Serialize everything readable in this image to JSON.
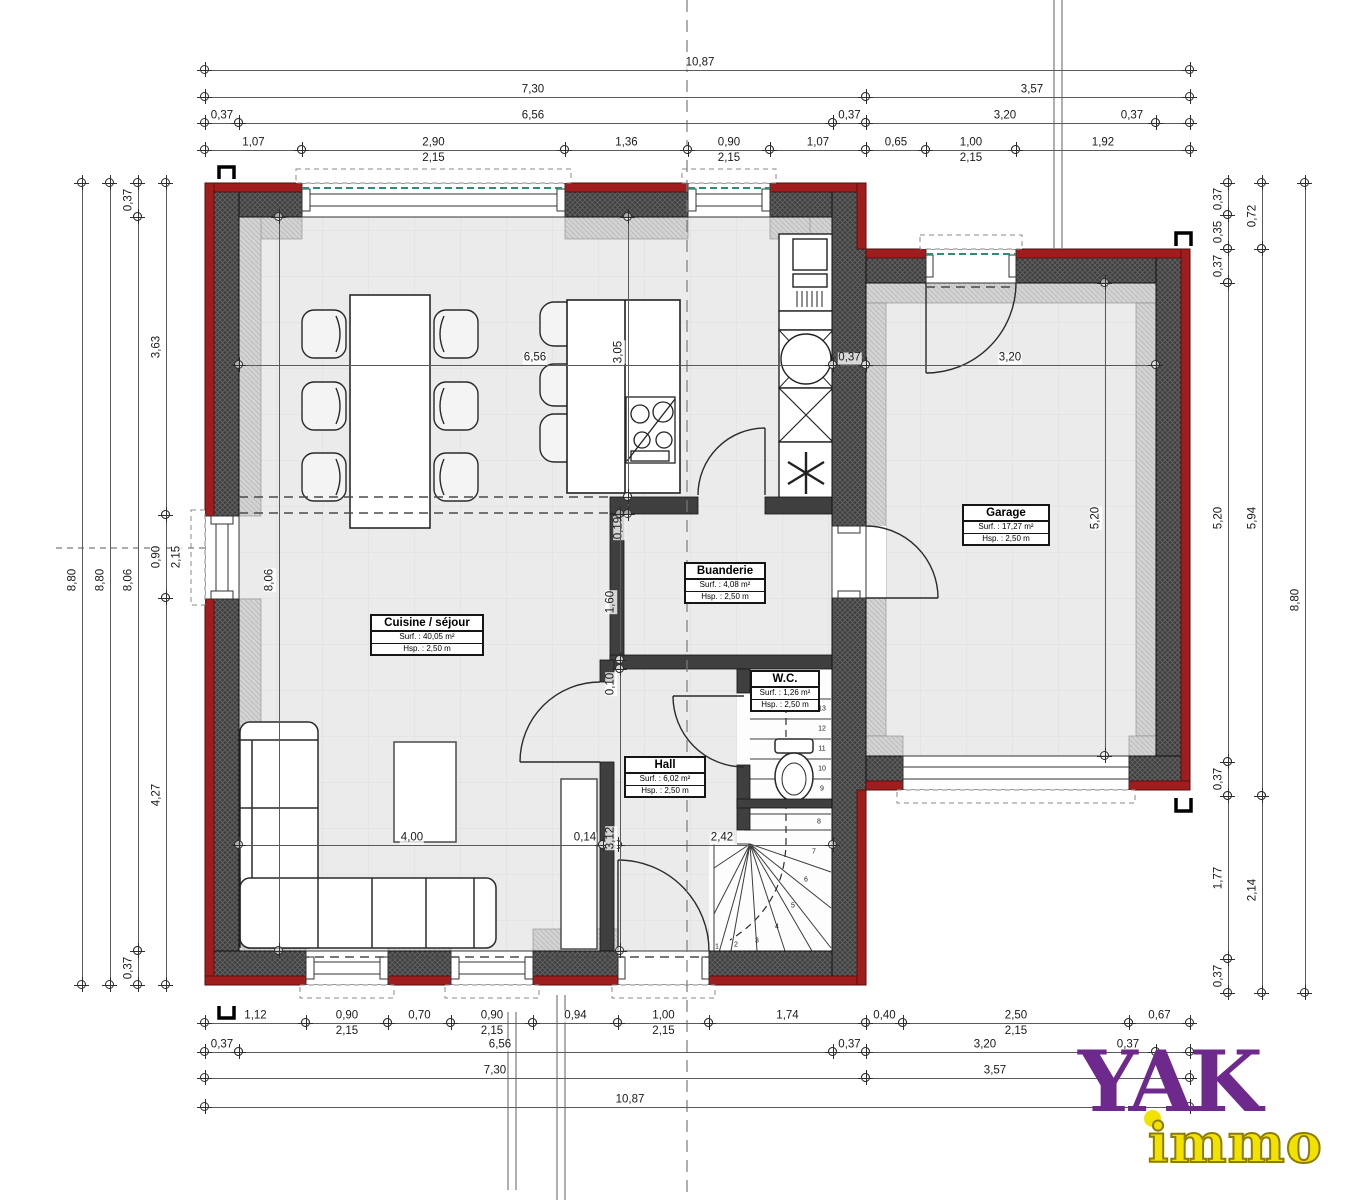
{
  "logo": {
    "brand": "YAK",
    "sub": "immo"
  },
  "colors": {
    "wall_red": "#a01d1d",
    "wall_dark": "#3f3f3f",
    "floor": "#ebebeb",
    "dim_line": "#5a5a5a",
    "brand_purple": "#6d2a8c",
    "brand_yellow": "#f2e200"
  },
  "rooms": [
    {
      "name": "Cuisine / séjour",
      "surface": "Surf. : 40,05 m²",
      "height": "Hsp. : 2,50 m",
      "x": 370,
      "y": 614,
      "w": 114
    },
    {
      "name": "Garage",
      "surface": "Surf. : 17,27 m²",
      "height": "Hsp. : 2,50 m",
      "x": 962,
      "y": 504,
      "w": 88
    },
    {
      "name": "Buanderie",
      "surface": "Surf. : 4,08 m²",
      "height": "Hsp. : 2,50 m",
      "x": 684,
      "y": 562,
      "w": 82
    },
    {
      "name": "W.C.",
      "surface": "Surf. : 1,26 m²",
      "height": "Hsp. : 2,50 m",
      "x": 750,
      "y": 670,
      "w": 70
    },
    {
      "name": "Hall",
      "surface": "Surf. : 6,02 m²",
      "height": "Hsp. : 2,50 m",
      "x": 624,
      "y": 756,
      "w": 82
    }
  ],
  "dims_h": [
    {
      "y": 70,
      "x1": 205,
      "x2": 1190,
      "t": "10,87",
      "lx": 700
    },
    {
      "y": 97,
      "x1": 205,
      "x2": 866,
      "t": "7,30",
      "lx": 533
    },
    {
      "y": 97,
      "x1": 866,
      "x2": 1190,
      "t": "3,57",
      "lx": 1032
    },
    {
      "y": 123,
      "x1": 205,
      "x2": 239,
      "t": "0,37"
    },
    {
      "y": 123,
      "x1": 239,
      "x2": 833,
      "t": "6,56",
      "lx": 533
    },
    {
      "y": 123,
      "x1": 833,
      "x2": 866,
      "t": "0,37"
    },
    {
      "y": 123,
      "x1": 866,
      "x2": 1156,
      "t": "3,20",
      "lx": 1005
    },
    {
      "y": 123,
      "x1": 1156,
      "x2": 1190,
      "t": "0,37",
      "lx": 1132
    },
    {
      "y": 150,
      "x1": 205,
      "x2": 302,
      "t": "1,07"
    },
    {
      "y": 150,
      "x1": 302,
      "x2": 565,
      "t": "2,90",
      "t2": "2,15"
    },
    {
      "y": 150,
      "x1": 565,
      "x2": 688,
      "t": "1,36"
    },
    {
      "y": 150,
      "x1": 688,
      "x2": 770,
      "t": "0,90",
      "t2": "2,15"
    },
    {
      "y": 150,
      "x1": 770,
      "x2": 866,
      "t": "1,07"
    },
    {
      "y": 150,
      "x1": 866,
      "x2": 926,
      "t": "0,65"
    },
    {
      "y": 150,
      "x1": 926,
      "x2": 1016,
      "t": "1,00",
      "t2": "2,15"
    },
    {
      "y": 150,
      "x1": 1016,
      "x2": 1190,
      "t": "1,92"
    },
    {
      "y": 365,
      "x1": 239,
      "x2": 833,
      "t": "6,56",
      "lx": 535
    },
    {
      "y": 365,
      "x1": 833,
      "x2": 866,
      "t": "0,37"
    },
    {
      "y": 365,
      "x1": 866,
      "x2": 1156,
      "t": "3,20",
      "lx": 1010
    },
    {
      "y": 845,
      "x1": 239,
      "x2": 603,
      "t": "4,00",
      "lx": 412
    },
    {
      "y": 845,
      "x1": 603,
      "x2": 618,
      "t": "0,14",
      "lx": 585
    },
    {
      "y": 845,
      "x1": 618,
      "x2": 833,
      "t": "2,42",
      "lx": 722
    },
    {
      "y": 1023,
      "x1": 205,
      "x2": 306,
      "t": "1,12"
    },
    {
      "y": 1023,
      "x1": 306,
      "x2": 388,
      "t": "0,90",
      "t2": "2,15"
    },
    {
      "y": 1023,
      "x1": 388,
      "x2": 451,
      "t": "0,70"
    },
    {
      "y": 1023,
      "x1": 451,
      "x2": 533,
      "t": "0,90",
      "t2": "2,15"
    },
    {
      "y": 1023,
      "x1": 533,
      "x2": 618,
      "t": "0,94"
    },
    {
      "y": 1023,
      "x1": 618,
      "x2": 709,
      "t": "1,00",
      "t2": "2,15"
    },
    {
      "y": 1023,
      "x1": 709,
      "x2": 866,
      "t": "1,74"
    },
    {
      "y": 1023,
      "x1": 866,
      "x2": 903,
      "t": "0,40"
    },
    {
      "y": 1023,
      "x1": 903,
      "x2": 1129,
      "t": "2,50",
      "t2": "2,15"
    },
    {
      "y": 1023,
      "x1": 1129,
      "x2": 1190,
      "t": "0,67"
    },
    {
      "y": 1052,
      "x1": 205,
      "x2": 239,
      "t": "0,37"
    },
    {
      "y": 1052,
      "x1": 239,
      "x2": 833,
      "t": "6,56",
      "lx": 500
    },
    {
      "y": 1052,
      "x1": 833,
      "x2": 866,
      "t": "0,37"
    },
    {
      "y": 1052,
      "x1": 866,
      "x2": 1156,
      "t": "3,20",
      "lx": 985
    },
    {
      "y": 1052,
      "x1": 1156,
      "x2": 1190,
      "t": "0,37",
      "lx": 1128
    },
    {
      "y": 1078,
      "x1": 205,
      "x2": 866,
      "t": "7,30",
      "lx": 495
    },
    {
      "y": 1078,
      "x1": 866,
      "x2": 1190,
      "t": "3,57",
      "lx": 995
    },
    {
      "y": 1107,
      "x1": 205,
      "x2": 1190,
      "t": "10,87",
      "lx": 630
    }
  ],
  "dims_v": [
    {
      "x": 82,
      "y1": 183,
      "y2": 985,
      "t": "8,80",
      "ly": 580
    },
    {
      "x": 110,
      "y1": 183,
      "y2": 985,
      "t": "8,80",
      "ly": 580
    },
    {
      "x": 138,
      "y1": 183,
      "y2": 217,
      "t": "0,37"
    },
    {
      "x": 138,
      "y1": 217,
      "y2": 951,
      "t": "8,06",
      "ly": 580
    },
    {
      "x": 138,
      "y1": 951,
      "y2": 985,
      "t": "0,37"
    },
    {
      "x": 166,
      "y1": 183,
      "y2": 515,
      "t": "3,63",
      "ly": 347
    },
    {
      "x": 166,
      "y1": 515,
      "y2": 598,
      "t": "0,90",
      "t2": "2,15"
    },
    {
      "x": 166,
      "y1": 598,
      "y2": 985,
      "t": "4,27",
      "ly": 795
    },
    {
      "x": 1228,
      "y1": 183,
      "y2": 215,
      "t": "0,37"
    },
    {
      "x": 1228,
      "y1": 215,
      "y2": 249,
      "t": "0,35"
    },
    {
      "x": 1228,
      "y1": 249,
      "y2": 283,
      "t": "0,37"
    },
    {
      "x": 1228,
      "y1": 283,
      "y2": 762,
      "t": "5,20",
      "ly": 518
    },
    {
      "x": 1228,
      "y1": 762,
      "y2": 796,
      "t": "0,37"
    },
    {
      "x": 1228,
      "y1": 796,
      "y2": 959,
      "t": "1,77",
      "ly": 878
    },
    {
      "x": 1228,
      "y1": 959,
      "y2": 993,
      "t": "0,37"
    },
    {
      "x": 1262,
      "y1": 183,
      "y2": 249,
      "t": "0,72"
    },
    {
      "x": 1262,
      "y1": 249,
      "y2": 796,
      "t": "5,94",
      "ly": 518
    },
    {
      "x": 1262,
      "y1": 796,
      "y2": 993,
      "t": "2,14",
      "ly": 890
    },
    {
      "x": 1305,
      "y1": 183,
      "y2": 993,
      "t": "8,80",
      "ly": 600
    },
    {
      "x": 279,
      "y1": 217,
      "y2": 951,
      "t": "8,06",
      "ly": 580
    },
    {
      "x": 628,
      "y1": 217,
      "y2": 497,
      "t": "3,05",
      "ly": 352
    },
    {
      "x": 628,
      "y1": 497,
      "y2": 514,
      "t": "0,19",
      "ly": 528
    },
    {
      "x": 620,
      "y1": 514,
      "y2": 660,
      "t": "1,60",
      "ly": 602
    },
    {
      "x": 620,
      "y1": 660,
      "y2": 669,
      "t": "0,10",
      "ly": 684
    },
    {
      "x": 620,
      "y1": 669,
      "y2": 951,
      "t": "3,12",
      "ly": 838
    },
    {
      "x": 1105,
      "y1": 283,
      "y2": 756,
      "t": "5,20",
      "ly": 518
    }
  ],
  "stair_numbers": [
    {
      "t": "13",
      "x": 822,
      "y": 709
    },
    {
      "t": "12",
      "x": 822,
      "y": 729
    },
    {
      "t": "11",
      "x": 822,
      "y": 749
    },
    {
      "t": "10",
      "x": 822,
      "y": 769
    },
    {
      "t": "9",
      "x": 822,
      "y": 789
    },
    {
      "t": "8",
      "x": 819,
      "y": 822
    },
    {
      "t": "7",
      "x": 814,
      "y": 852
    },
    {
      "t": "6",
      "x": 806,
      "y": 880
    },
    {
      "t": "5",
      "x": 793,
      "y": 906
    },
    {
      "t": "4",
      "x": 777,
      "y": 927
    },
    {
      "t": "3",
      "x": 757,
      "y": 941
    },
    {
      "t": "2",
      "x": 736,
      "y": 945
    },
    {
      "t": "1",
      "x": 717,
      "y": 947
    }
  ]
}
